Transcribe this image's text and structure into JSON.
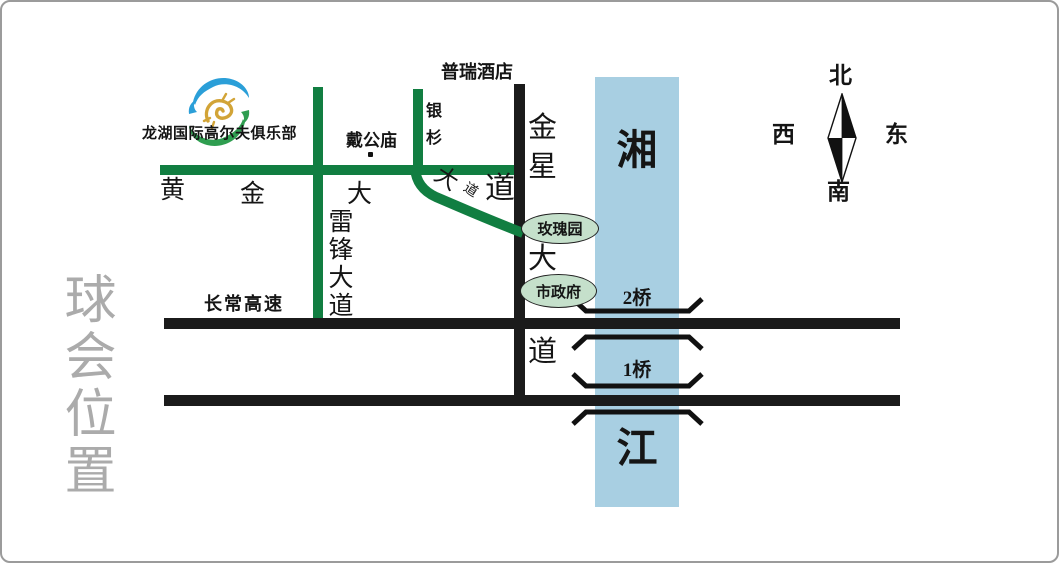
{
  "title": {
    "vertical_text": "球会位置"
  },
  "logo": {
    "club_name": "龙湖国际高尔夫俱乐部"
  },
  "landmarks": {
    "hotel": "普瑞酒店",
    "temple": "戴公庙",
    "rose_garden": "玫瑰园",
    "city_hall": "市政府"
  },
  "roads": {
    "huangjin": {
      "name": "黄金大道",
      "char_1": "黄",
      "char_2": "金",
      "char_3": "大",
      "char_4": "道",
      "bend_char_1": "大",
      "bend_char_2": "道"
    },
    "leifeng": {
      "name": "雷锋大道"
    },
    "yinshan": {
      "name": "银杉"
    },
    "jinxing": {
      "name": "金星大道",
      "char_1": "金",
      "char_2": "星",
      "char_3": "大",
      "char_4": "道"
    },
    "highway": {
      "name": "长常高速"
    }
  },
  "river": {
    "name": "湘江",
    "char_1": "湘",
    "char_2": "江"
  },
  "bridges": {
    "bridge_2": "2桥",
    "bridge_1": "1桥"
  },
  "compass": {
    "north": "北",
    "south": "南",
    "west": "西",
    "east": "东"
  },
  "colors": {
    "road_green": "#117e41",
    "road_black": "#1b1b1b",
    "river_blue": "#a8cfe2",
    "landmark_fill": "#c5e0cb",
    "title_gray": "#ababab",
    "logo_blue": "#2b9fd8",
    "logo_green": "#2f9e50",
    "logo_gold": "#d2a437"
  }
}
